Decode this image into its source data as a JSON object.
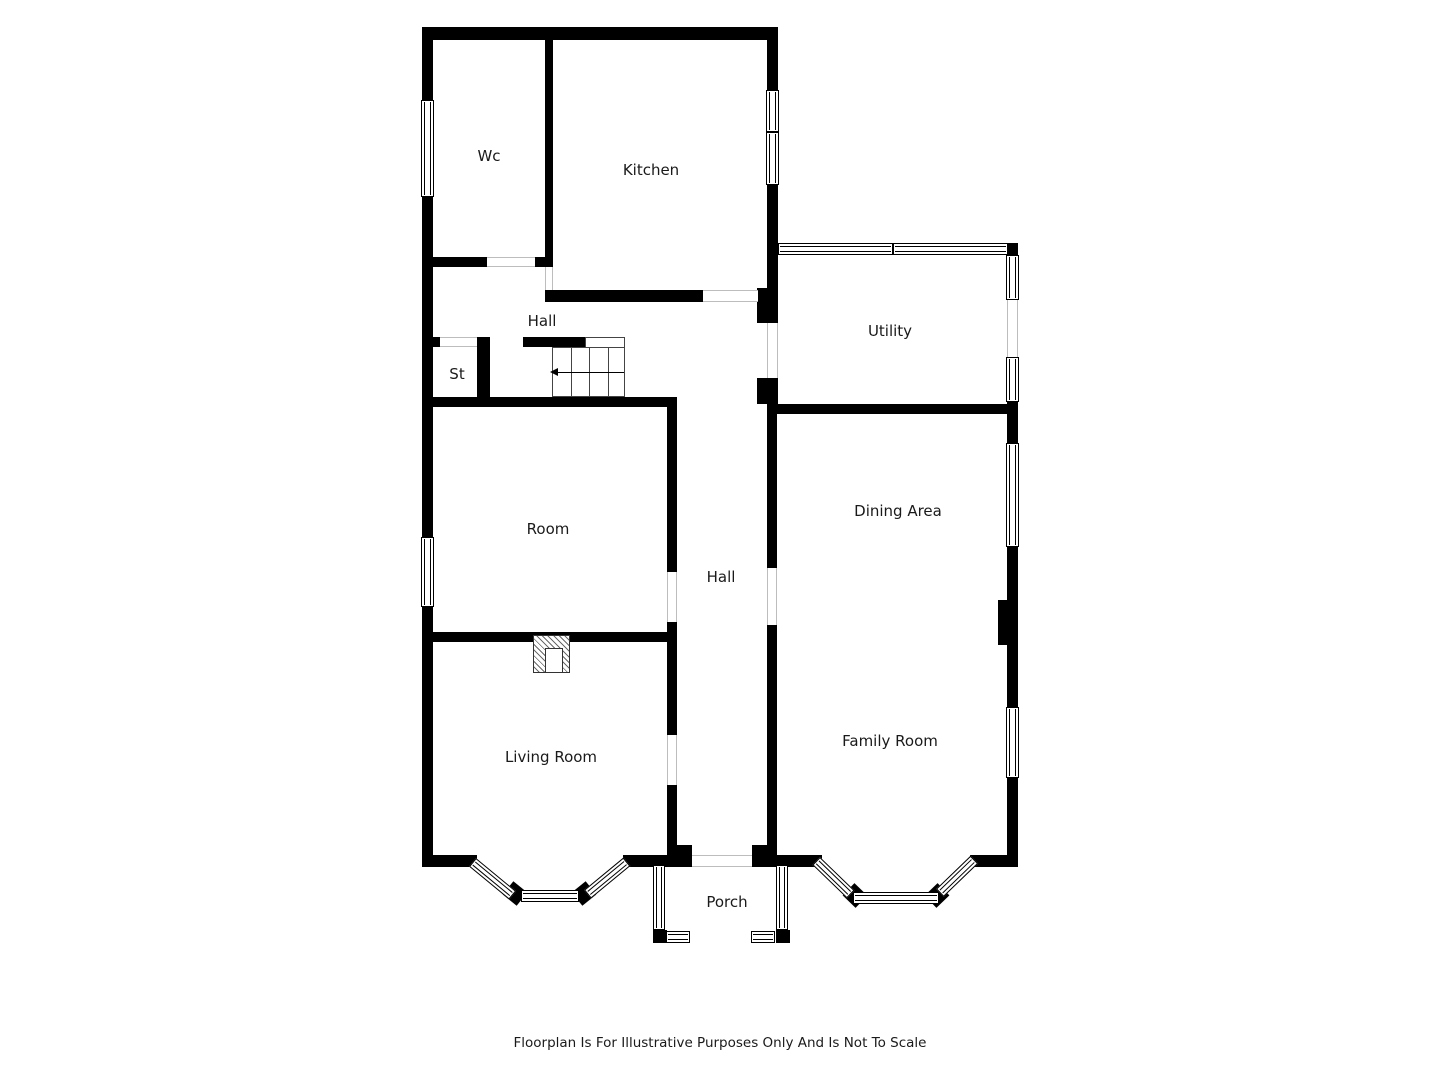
{
  "rooms": {
    "wc": "Wc",
    "kitchen": "Kitchen",
    "hall_upper": "Hall",
    "st": "St",
    "utility": "Utility",
    "room": "Room",
    "hall_lower": "Hall",
    "dining": "Dining Area",
    "family": "Family Room",
    "living": "Living Room",
    "porch": "Porch"
  },
  "disclaimer": "Floorplan Is For Illustrative Purposes Only And Is Not To Scale",
  "icons": {
    "stairs_arrow": "left-arrow"
  },
  "colors": {
    "background": "#ffffff",
    "wall": "#000000",
    "window_frame": "#000000",
    "opening_line": "#bdbdbd",
    "text": "#1a1a1a"
  }
}
